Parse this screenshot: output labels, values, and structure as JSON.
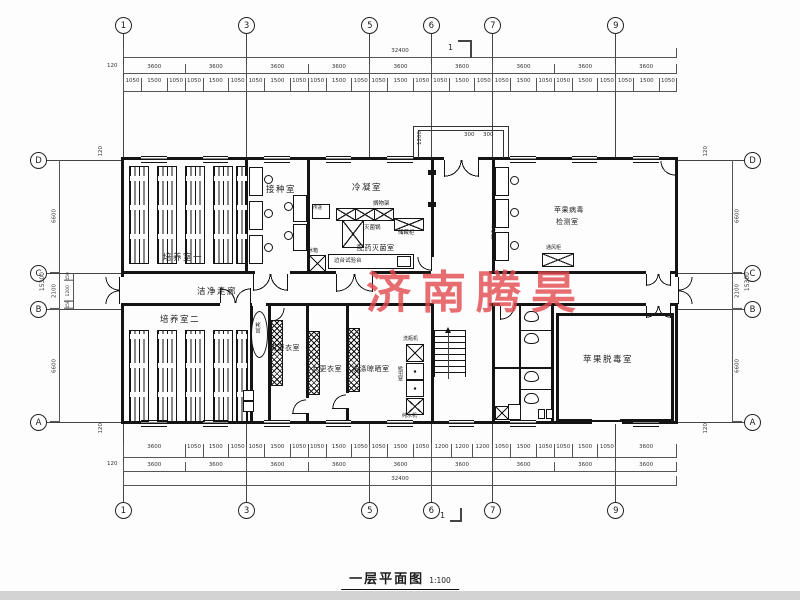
{
  "title": {
    "text": "一层平面图",
    "scale": "1:100"
  },
  "watermark": {
    "text": "济南腾昊",
    "color": "#e24a4f"
  },
  "axes": {
    "cols": [
      "1",
      "3",
      "5",
      "6",
      "7",
      "9"
    ],
    "rows": [
      "D",
      "C",
      "B",
      "A"
    ]
  },
  "marks": {
    "section": "1"
  },
  "dims": {
    "overall_w": "32400",
    "overall_h": "15300",
    "edge": "120",
    "bays": [
      "3600",
      "3600",
      "3600",
      "3600",
      "3600",
      "3600",
      "3600",
      "3600",
      "3600"
    ],
    "sub_top": [
      "1050",
      "1500",
      "1050",
      "1050",
      "1500",
      "1050",
      "1050",
      "1500",
      "1050",
      "1050",
      "1500",
      "1050",
      "1050",
      "1500",
      "1050",
      "1050",
      "1500",
      "1050",
      "1050",
      "1500",
      "1050",
      "1050",
      "1500",
      "1050",
      "1050",
      "1500",
      "1050"
    ],
    "sub_bottom": [
      "3600",
      "1050",
      "1500",
      "1050",
      "1050",
      "1500",
      "1050",
      "1050",
      "1500",
      "1050",
      "1050",
      "1500",
      "1050",
      "1200",
      "1200",
      "1200",
      "1050",
      "1500",
      "1050",
      "1050",
      "1500",
      "1050",
      "3600"
    ],
    "side": [
      "6600",
      "2100",
      "6600"
    ],
    "side_sub": [
      "450",
      "1200",
      "450"
    ],
    "porch_depth": "1200",
    "porch_a": "300",
    "porch_b": "300"
  },
  "rooms": {
    "cultivation1": "培养室一",
    "cultivation2": "培养室二",
    "inoculation": "接种室",
    "condensation": "冷凝室",
    "prep": "配药灭菌室",
    "detection_line1": "苹果病毒",
    "detection_line2": "检测室",
    "corridor": "洁净走廊",
    "men_changing": "男更衣室",
    "women_changing": "女更衣室",
    "laundry": "洗涤晾晒室",
    "detox": "苹果脱毒室",
    "air_shower": "风淋"
  },
  "equipment": {
    "pass_window": "传递",
    "fridge": "冰箱",
    "shelf": "搁物架",
    "sterilizer": "灭菌锅",
    "cabinet": "储藏柜",
    "side_bench": "边台试验台",
    "clean_bench": "超净台",
    "fume_hood": "通风柜",
    "bottle_washer": "洗瓶机",
    "autoclave": "高压锅",
    "water_purifier": "纯水机"
  }
}
